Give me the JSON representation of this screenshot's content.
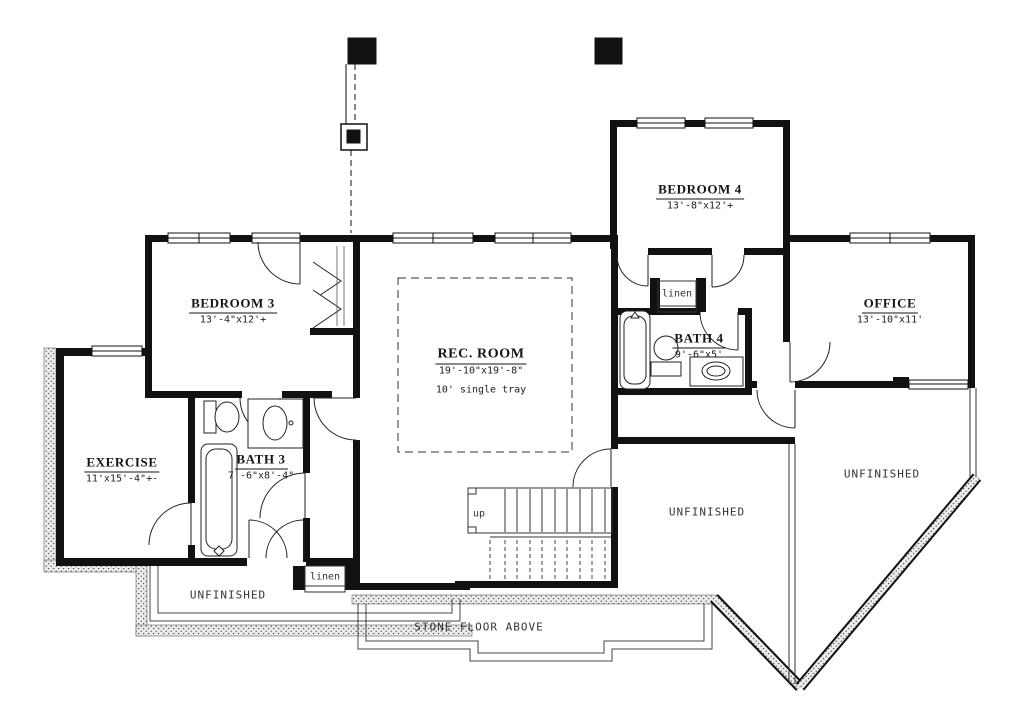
{
  "plan": {
    "rooms": [
      {
        "name": "BEDROOM 3",
        "dims": "13'-4\"x12'+"
      },
      {
        "name": "EXERCISE",
        "dims": "11'x15'-4\"+-"
      },
      {
        "name": "BATH 3",
        "dims": "7'-6\"x8'-4\""
      },
      {
        "name": "REC. ROOM",
        "dims": "19'-10\"x19'-8\"",
        "note": "10' single tray"
      },
      {
        "name": "BEDROOM 4",
        "dims": "13'-8\"x12'+"
      },
      {
        "name": "BATH 4",
        "dims": "9'-6\"x5'"
      },
      {
        "name": "OFFICE",
        "dims": "13'-10\"x11'"
      }
    ],
    "areas": {
      "unfinished_left": "UNFINISHED",
      "unfinished_center": "UNFINISHED",
      "unfinished_right": "UNFINISHED",
      "linen_top": "linen",
      "linen_bottom": "linen",
      "stairs_up": "up",
      "stone_floor": "STONE FLOOR ABOVE"
    },
    "colors": {
      "wall": "#111111",
      "paper": "#ffffff",
      "stipple_bg": "#ececec"
    }
  }
}
